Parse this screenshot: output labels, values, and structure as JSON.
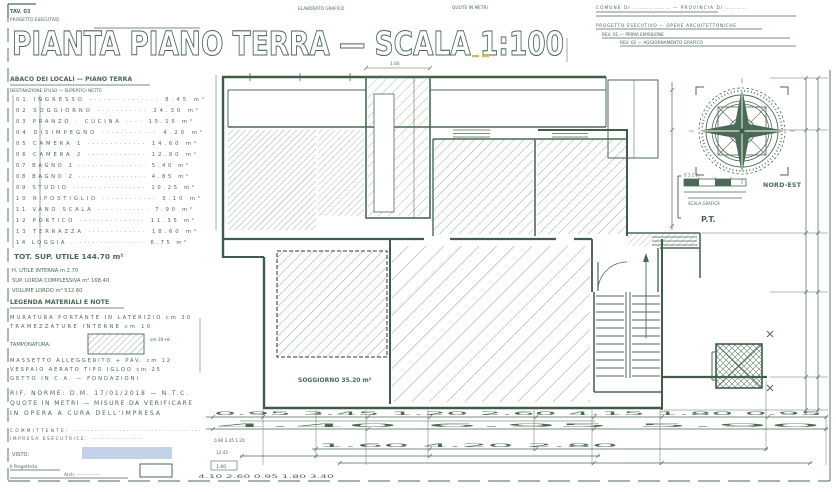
{
  "colors": {
    "ink": "#4a6a54",
    "ink_dark": "#3f5c48",
    "hatch": "#5a7c64",
    "highlight": "#c4d2e8",
    "accent": "#d9b84e"
  },
  "header": {
    "sheet_tag": "TAV. 03",
    "sheet_sub": "PROGETTO ESECUTIVO",
    "note_left": "ELABORATO GRAFICO",
    "note_right": "QUOTE IN METRI",
    "title": "PIANTA PIANO TERRA — SCALA 1:100"
  },
  "revisions": {
    "row0": "COMUNE DI ………………… — PROVINCIA DI …………",
    "row1": "PROGETTO ESECUTIVO — OPERE ARCHITETTONICHE",
    "row2": "REV. 01 — PRIMA EMISSIONE",
    "row3": "REV. 02 — AGGIORNAMENTO GRAFICO"
  },
  "compass": {
    "label": "NORD-EST",
    "scale_ticks": "0   1   2   5",
    "scale_caption": "SCALA GRAFICA",
    "stamp": "P.T."
  },
  "schedule": {
    "heading": "ABACO DEI LOCALI — PIANO TERRA",
    "subheading": "DESTINAZIONE D'USO — SUPERFICI NETTE",
    "rows": [
      "01  INGRESSO ··············· 8.45 m²",
      "02  SOGGIORNO ··········· 24.30 m²",
      "03  PRANZO · CUCINA ···· 15.15 m²",
      "04  DISIMPEGNO ············ 4.20 m²",
      "05  CAMERA 1 ············· 14.60 m²",
      "06  CAMERA 2 ············· 12.80 m²",
      "07  BAGNO 1 ················ 5.40 m²",
      "08  BAGNO 2 ················ 4.85 m²",
      "09  STUDIO ················· 10.25 m²",
      "10  RIPOSTIGLIO ············ 3.10 m²",
      "11  VANO SCALA ············ 7.90 m²",
      "12  PORTICO ··············· 11.35 m²",
      "13  TERRAZZA ············· 18.60 m²",
      "14  LOGGIA ·················· 6.75 m²"
    ],
    "total": "TOT. SUP. UTILE  144.70 m²",
    "note1": "H. UTILE INTERNA m 2.70",
    "note2": "SUP. LORDA COMPLESSIVA m² 168.40",
    "note3": "VOLUME LORDO m³ 512.60"
  },
  "legend": {
    "heading": "LEGENDA MATERIALI E NOTE",
    "row1": "MURATURA PORTANTE IN LATERIZIO cm 30",
    "row2": "TRAMEZZATURE INTERNE cm 10",
    "swatch_label": "TAMPONATURA:",
    "swatch_value": "cm 30+8",
    "row3": "MASSETTO ALLEGGERITO + PAV. cm 12",
    "row4": "VESPAIO AERATO TIPO IGLOO cm 25",
    "row5": "GETTO IN C.A. — FONDAZIONI",
    "foot1": "RIF. NORME: D.M. 17/01/2018 — N.T.C.",
    "foot2": "QUOTE IN METRI — MISURE DA VERIFICARE",
    "foot3": "IN OPERA A CURA DELL'IMPRESA"
  },
  "footer": {
    "row1": "COMMITTENTE: ····································",
    "row2": "IMPRESA ESECUTRICE: ··················",
    "visto": "VISTO:",
    "sign1": "Il Progettista",
    "sign2": "Arch. ··················"
  },
  "plan": {
    "room_label": "SOGGIORNO 35.20 m²",
    "shaft_dim": "1.60"
  },
  "dims": {
    "chain1": "0.95   3.45   1.20   2.60   4.15   1.80   0.95",
    "chain2": "4.40   6.95   5.90",
    "chain3": "1.60   4.20   2.80",
    "left_a": "0.90  3.45  1.20",
    "left_b": "12.45",
    "left_c": "1.60",
    "left_d": "4.10   2.60   0.95   1.80   3.40"
  }
}
